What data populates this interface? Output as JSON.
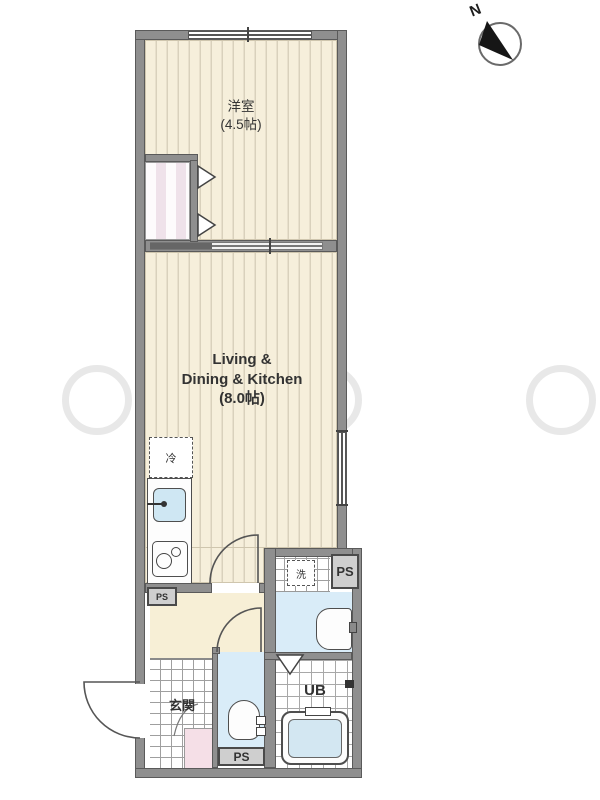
{
  "meta": {
    "type": "apartment-floor-plan"
  },
  "compass": {
    "north_label": "N"
  },
  "rooms": {
    "western_room": {
      "name": "洋室",
      "size": "(4.5帖)"
    },
    "ldk": {
      "name_line1": "Living &",
      "name_line2": "Dining & Kitchen",
      "size": "(8.0帖)"
    },
    "entrance": {
      "name": "玄関"
    },
    "unit_bath": {
      "name": "UB"
    }
  },
  "fixtures": {
    "refrigerator_label": "冷",
    "washing_machine_label": "洗"
  },
  "pipe_spaces": {
    "upper": "PS",
    "lower": "PS",
    "left": "PS"
  },
  "colors": {
    "wall": "#8f8f8f",
    "room_floor": "#f6efdb",
    "hallway_floor": "#f7efd6",
    "wet_area_floor": "#d9ecf8",
    "fixture_blue": "#cfe7f3",
    "step_pink": "#f5dfe7"
  }
}
